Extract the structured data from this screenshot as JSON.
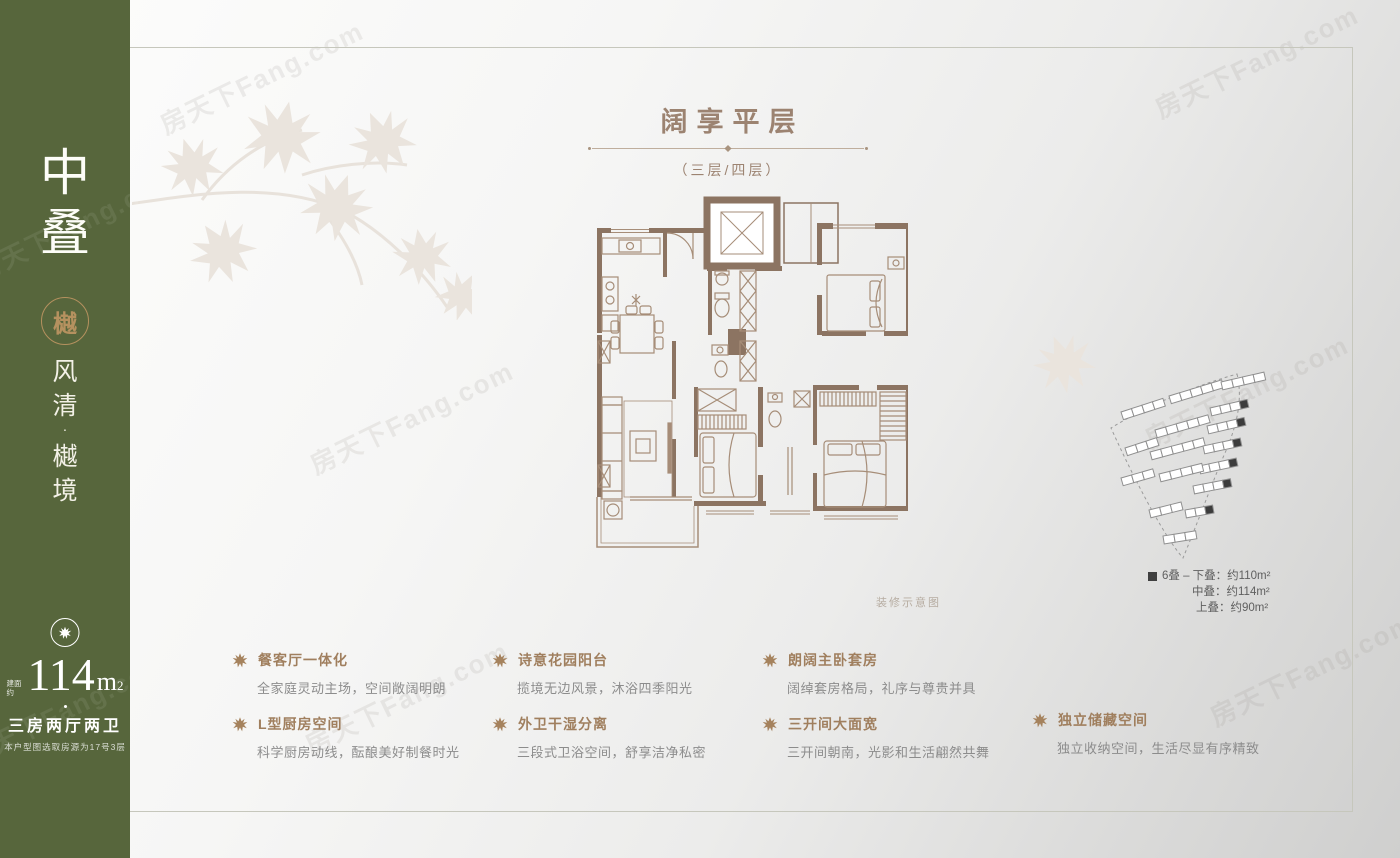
{
  "watermark": {
    "text": "房天下Fang.com"
  },
  "sidebar": {
    "name_chars": [
      "中",
      "叠"
    ],
    "seal_char": "樾",
    "slogan_chars": [
      "风",
      "清",
      "·",
      "樾",
      "境"
    ],
    "area_prefix": "建面约",
    "area_value": "114",
    "area_unit": "m",
    "area_sup": "2",
    "layout": "三房两厅两卫",
    "note": "本户型图选取房源为17号3层"
  },
  "header": {
    "title": "阔享平层",
    "subtitle": "（三层/四层）"
  },
  "floorplan": {
    "caption": "装修示意图"
  },
  "legend": {
    "marker_color": "#3f3f3f",
    "lines": [
      "6叠 – 下叠：约110m²",
      "中叠：约114m²",
      "上叠：约90m²"
    ]
  },
  "features": [
    {
      "title": "餐客厅一体化",
      "desc": "全家庭灵动主场，空间敞阔明朗"
    },
    {
      "title": "L型厨房空间",
      "desc": "科学厨房动线，酝酿美好制餐时光"
    },
    {
      "title": "诗意花园阳台",
      "desc": "揽境无边风景，沐浴四季阳光"
    },
    {
      "title": "外卫干湿分离",
      "desc": "三段式卫浴空间，舒享洁净私密"
    },
    {
      "title": "朗阔主卧套房",
      "desc": "阔绰套房格局，礼序与尊贵并具"
    },
    {
      "title": "三开间大面宽",
      "desc": "三开间朝南，光影和生活翩然共舞"
    },
    {
      "title": "独立储藏空间",
      "desc": "独立收纳空间，生活尽显有序精致"
    }
  ],
  "colors": {
    "sidebar_green": "#57663c",
    "gold": "#b5915f",
    "title_brown": "#9c8371",
    "wall_brown": "#8c7462",
    "text_gray": "#8c8c8c",
    "legend_marker": "#3f3f3f"
  }
}
